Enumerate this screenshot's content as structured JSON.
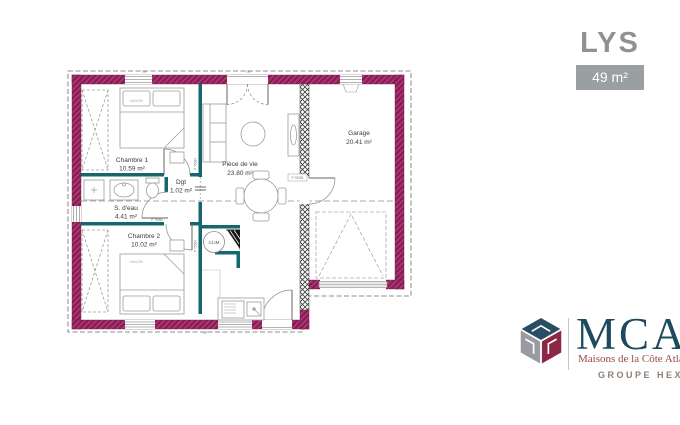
{
  "header": {
    "title": "LYS",
    "area_badge": "49 m²"
  },
  "plan": {
    "rooms": [
      {
        "name": "Chambre 1",
        "area": "10.59 m²"
      },
      {
        "name": "S. d'eau",
        "area": "4.41 m²"
      },
      {
        "name": "Chambre 2",
        "area": "10.02 m²"
      },
      {
        "name": "Dgt",
        "area": "1.02 m²"
      },
      {
        "name": "Pièce de vie",
        "area": "23.80 m²"
      },
      {
        "name": "Garage",
        "area": "20.41 m²"
      }
    ],
    "labels": {
      "clim": "CLIM",
      "bed_size": "140x190",
      "door_ref": "P 75084",
      "shutter": "VR"
    },
    "colors": {
      "wall": "#8e1d57",
      "partition": "#15666f",
      "crosshatch": "#3b3b3b",
      "furniture": "#9c9c9c",
      "title_gray": "#8f9194",
      "badge_bg": "#9aa0a1"
    }
  },
  "logo": {
    "brand": "MCA",
    "tagline": "Maisons de la Côte Atlantique",
    "group": "GROUPE Hexa",
    "colors": {
      "navy": "#1d4a5f",
      "red": "#9c493c",
      "gray": "#9a9ba0",
      "maroon": "#8c2846"
    }
  }
}
